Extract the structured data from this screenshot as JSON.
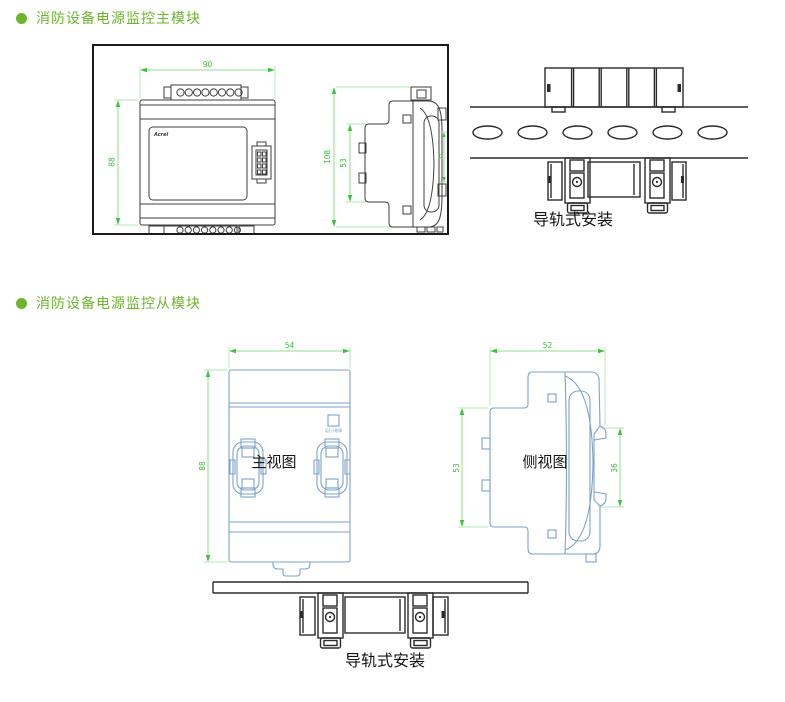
{
  "colors": {
    "accent_green": "#6cb52d",
    "dimension_green": "#3bbd3b",
    "drawing_blue": "#7da3c8",
    "drawing_dark": "#3d3d3d"
  },
  "sections": {
    "main": {
      "title": "消防设备电源监控主模块",
      "front": {
        "logo": "Acrel",
        "dim_width": "90",
        "dim_height": "88"
      },
      "side": {
        "dim_total_height": "108",
        "dim_body_height": "53",
        "dim_rail": "35"
      },
      "rail": {
        "caption": "导轨式安装"
      }
    },
    "slave": {
      "title": "消防设备电源监控从模块",
      "front": {
        "label": "主视图",
        "dim_width": "54",
        "dim_height": "88",
        "led_label": "运行/故障"
      },
      "side": {
        "label": "侧视图",
        "dim_width": "52",
        "dim_height": "53",
        "dim_rail": "36"
      },
      "rail": {
        "caption": "导轨式安装"
      }
    }
  }
}
